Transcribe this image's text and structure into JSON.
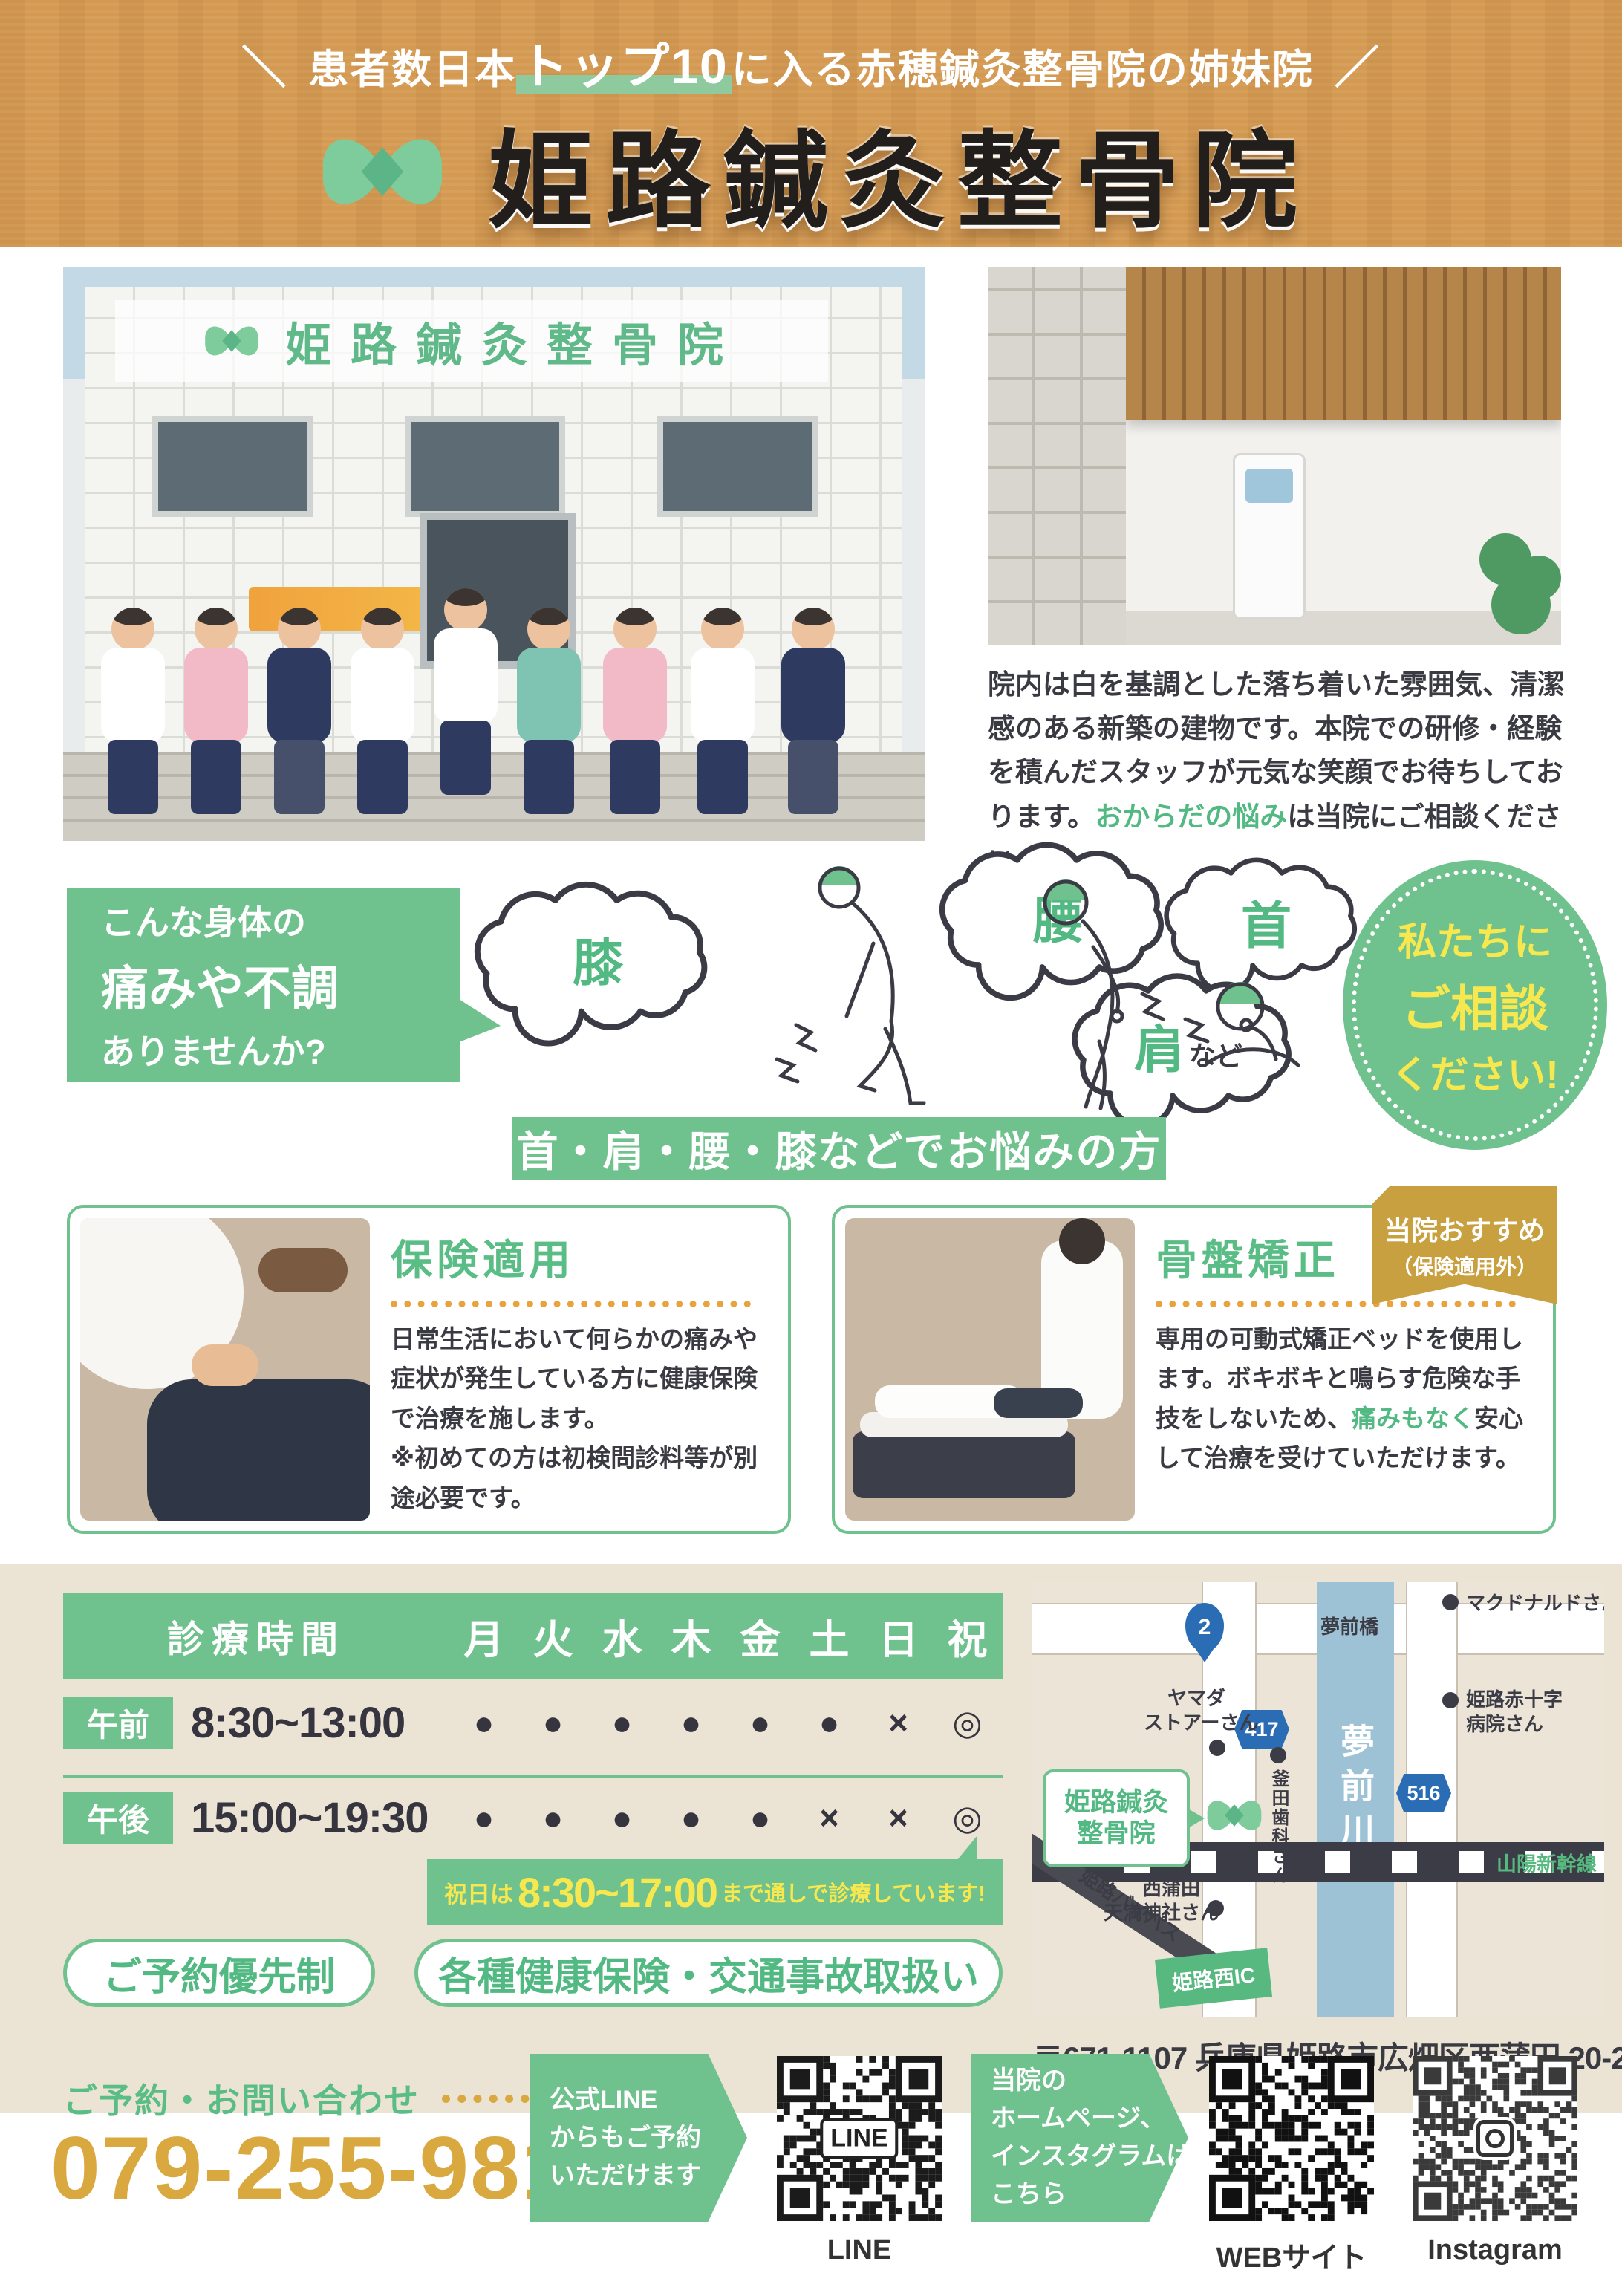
{
  "colors": {
    "accent_green": "#6fc18d",
    "text_green": "#53b983",
    "banner_orange": "#d49a52",
    "gold": "#d9a83f",
    "badge_gold": "#c9a03f",
    "yellow": "#f6e84e",
    "dark": "#3a3a42",
    "beige": "#ebe3d4",
    "river_blue": "#9dc2d5",
    "road_sign_blue": "#2a6db5"
  },
  "banner": {
    "tagline_open": "＼",
    "tagline_pre": "患者数日本",
    "tagline_hl": "トップ10",
    "tagline_post": "に入る赤穂鍼灸整骨院の姉妹院",
    "tagline_close": "／",
    "title": "姫路鍼灸整骨院"
  },
  "intro": {
    "sign_text": "姫路鍼灸整骨院",
    "body": "院内は白を基調とした落ち着いた雰囲気、清潔感のある新築の建物です。本院での研修・経験を積んだスタッフが元気な笑顔でお待ちしております。",
    "hl": "おからだの悩み",
    "tail": "は当院にご相談ください。"
  },
  "pain": {
    "ask1": "こんな身体の",
    "ask2": "痛みや不調",
    "ask3": "ありませんか?",
    "knee": "膝",
    "back": "腰",
    "neck": "首",
    "shoulder": "肩",
    "etc": "など",
    "consult1": "私たちに",
    "consult2": "ご相談",
    "consult3": "ください!",
    "banner": "首・肩・腰・膝などでお悩みの方"
  },
  "cards": [
    {
      "title": "保険適用",
      "body": "日常生活において何らかの痛みや症状が発生している方に健康保険で治療を施します。",
      "note": "※初めての方は初検問診料等が別途必要です。"
    },
    {
      "title": "骨盤矯正",
      "badge1": "当院おすすめ",
      "badge2": "（保険適用外）",
      "body_pre": "専用の可動式矯正ベッドを使用します。ボキボキと鳴らす危険な手技をしないため、",
      "body_hl": "痛みもなく",
      "body_post": "安心して治療を受けていただけます。"
    }
  ],
  "schedule": {
    "title": "診療時間",
    "days": [
      "月",
      "火",
      "水",
      "木",
      "金",
      "土",
      "日",
      "祝"
    ],
    "rows": [
      {
        "label": "午前",
        "time": "8:30~13:00",
        "marks": [
          "●",
          "●",
          "●",
          "●",
          "●",
          "●",
          "×",
          "◎"
        ]
      },
      {
        "label": "午後",
        "time": "15:00~19:30",
        "marks": [
          "●",
          "●",
          "●",
          "●",
          "●",
          "×",
          "×",
          "◎"
        ]
      }
    ],
    "holiday_pre": "祝日は",
    "holiday_time": "8:30~17:00",
    "holiday_post": "まで通しで診療しています!",
    "pill1": "ご予約優先制",
    "pill2": "各種健康保険・交通事故取扱い"
  },
  "map": {
    "clinic1": "姫路鍼灸",
    "clinic2": "整骨院",
    "river": "夢前川",
    "bridge": "夢前橋",
    "route2": "2",
    "route417": "417",
    "route516": "516",
    "mcdonalds": "マクドナルドさん",
    "yamada1": "ヤマダ",
    "yamada2": "ストアーさん",
    "redcross1": "姫路赤十字",
    "redcross2": "病院さん",
    "dental": "釜田歯科さん",
    "shrine1": "西蒲田",
    "shrine2": "天満神社さん",
    "bypass": "姫路バイパス",
    "ic": "姫路西IC",
    "shinkansen": "山陽新幹線",
    "address": "〒671-1107 兵庫県姫路市広畑区西蒲田 20-2"
  },
  "contact": {
    "label": "ご予約・お問い合わせ",
    "phone": "079-255-9816",
    "line_box": [
      "公式LINE",
      "からもご予約",
      "いただけます"
    ],
    "line_qr_center": "LINE",
    "line_label": "LINE",
    "web_box": [
      "当院の",
      "ホームページ、",
      "インスタグラムは",
      "こちら"
    ],
    "web_label": "WEBサイト",
    "ig_label": "Instagram"
  }
}
